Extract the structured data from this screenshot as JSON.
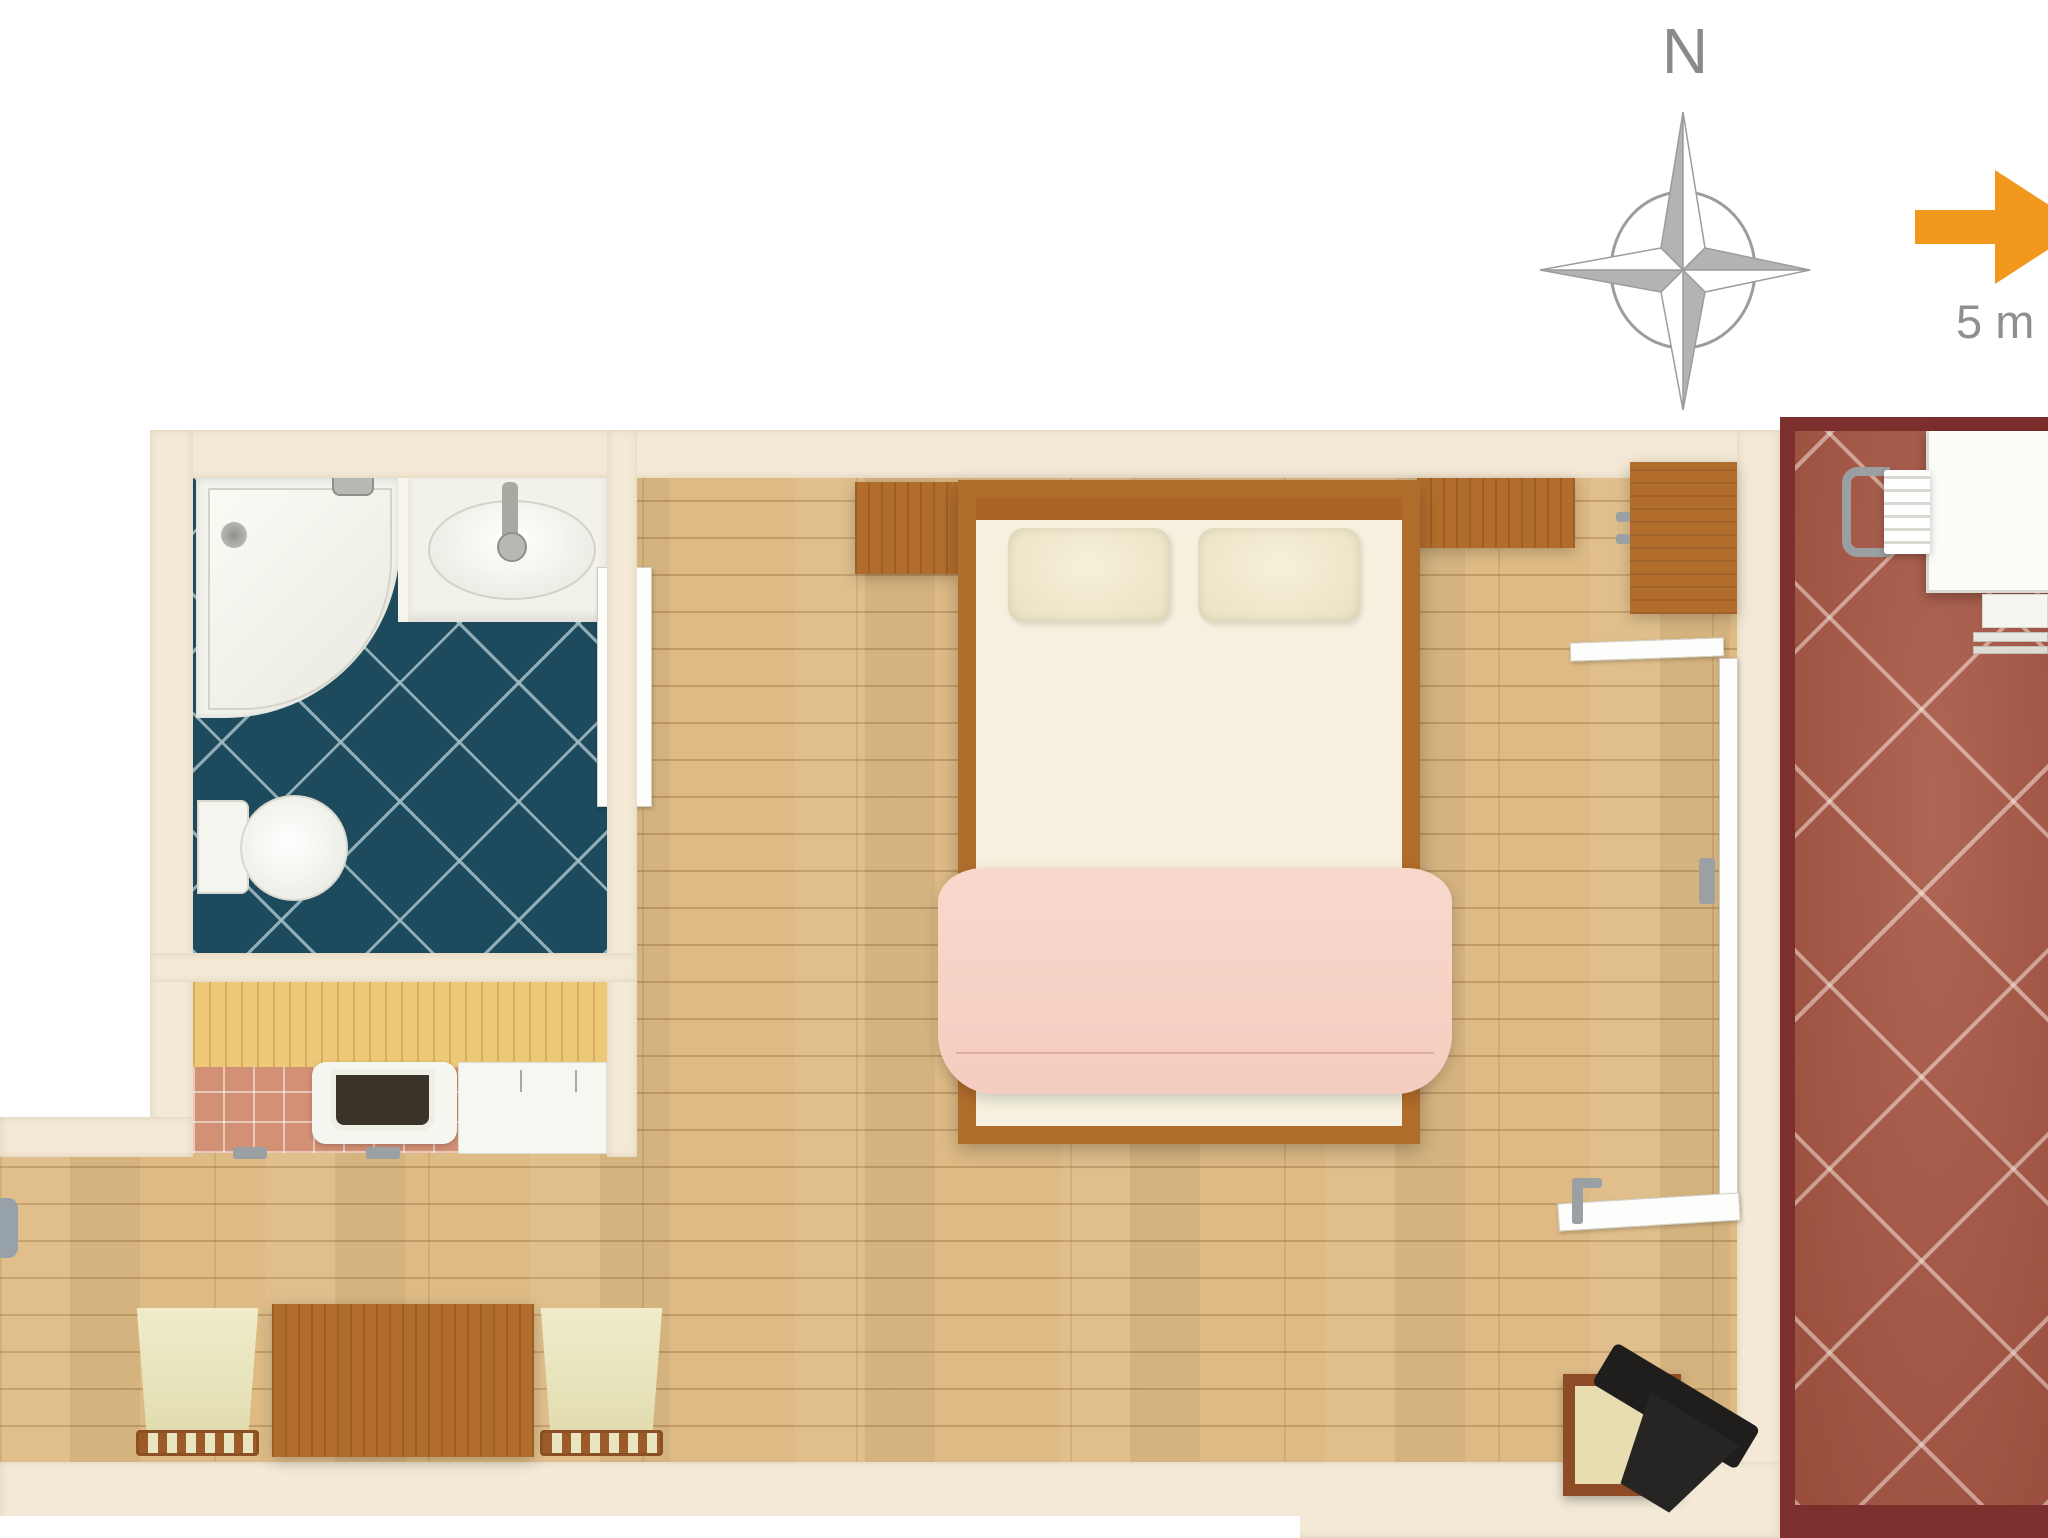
{
  "compass": {
    "north_label": "N",
    "direction_up": "north"
  },
  "scale_bar": {
    "label": "5 m",
    "arrow_color": "#f2981d"
  },
  "plan": {
    "type": "studio-apartment-floor-plan-top-view",
    "rooms": [
      {
        "name": "bathroom",
        "floor": "dark teal diagonal tiles",
        "fixtures": [
          "corner-shower",
          "washbasin",
          "toilet",
          "sliding-door"
        ]
      },
      {
        "name": "kitchenette",
        "features": [
          "wood-counter",
          "inset-sink",
          "appliance",
          "terracotta-tiling"
        ]
      },
      {
        "name": "bedroom-living-area",
        "floor": "light wood planks",
        "furniture": [
          "double-bed",
          "two-pillows",
          "pink-blanket",
          "bedside-cabinet",
          "headboard-shelf",
          "wardrobe",
          "dining-table",
          "dining-chair-left",
          "dining-chair-right",
          "tv-on-stand"
        ]
      },
      {
        "name": "terrace",
        "floor": "terracotta diagonal tiles",
        "furniture": [
          "terrace-table",
          "terrace-chair",
          "terrace-bench"
        ]
      }
    ],
    "colors": {
      "wall": "#f3e9d6",
      "wood_floor": "#debb85",
      "bathroom_tile": "#1d4a5d",
      "terrace_tile": "#a65441",
      "terrace_wall": "#7c2f2c",
      "bed_blanket": "#f8d5c9",
      "furniture_wood": "#b26d2c",
      "compass_gray": "#9c9c9c"
    }
  }
}
